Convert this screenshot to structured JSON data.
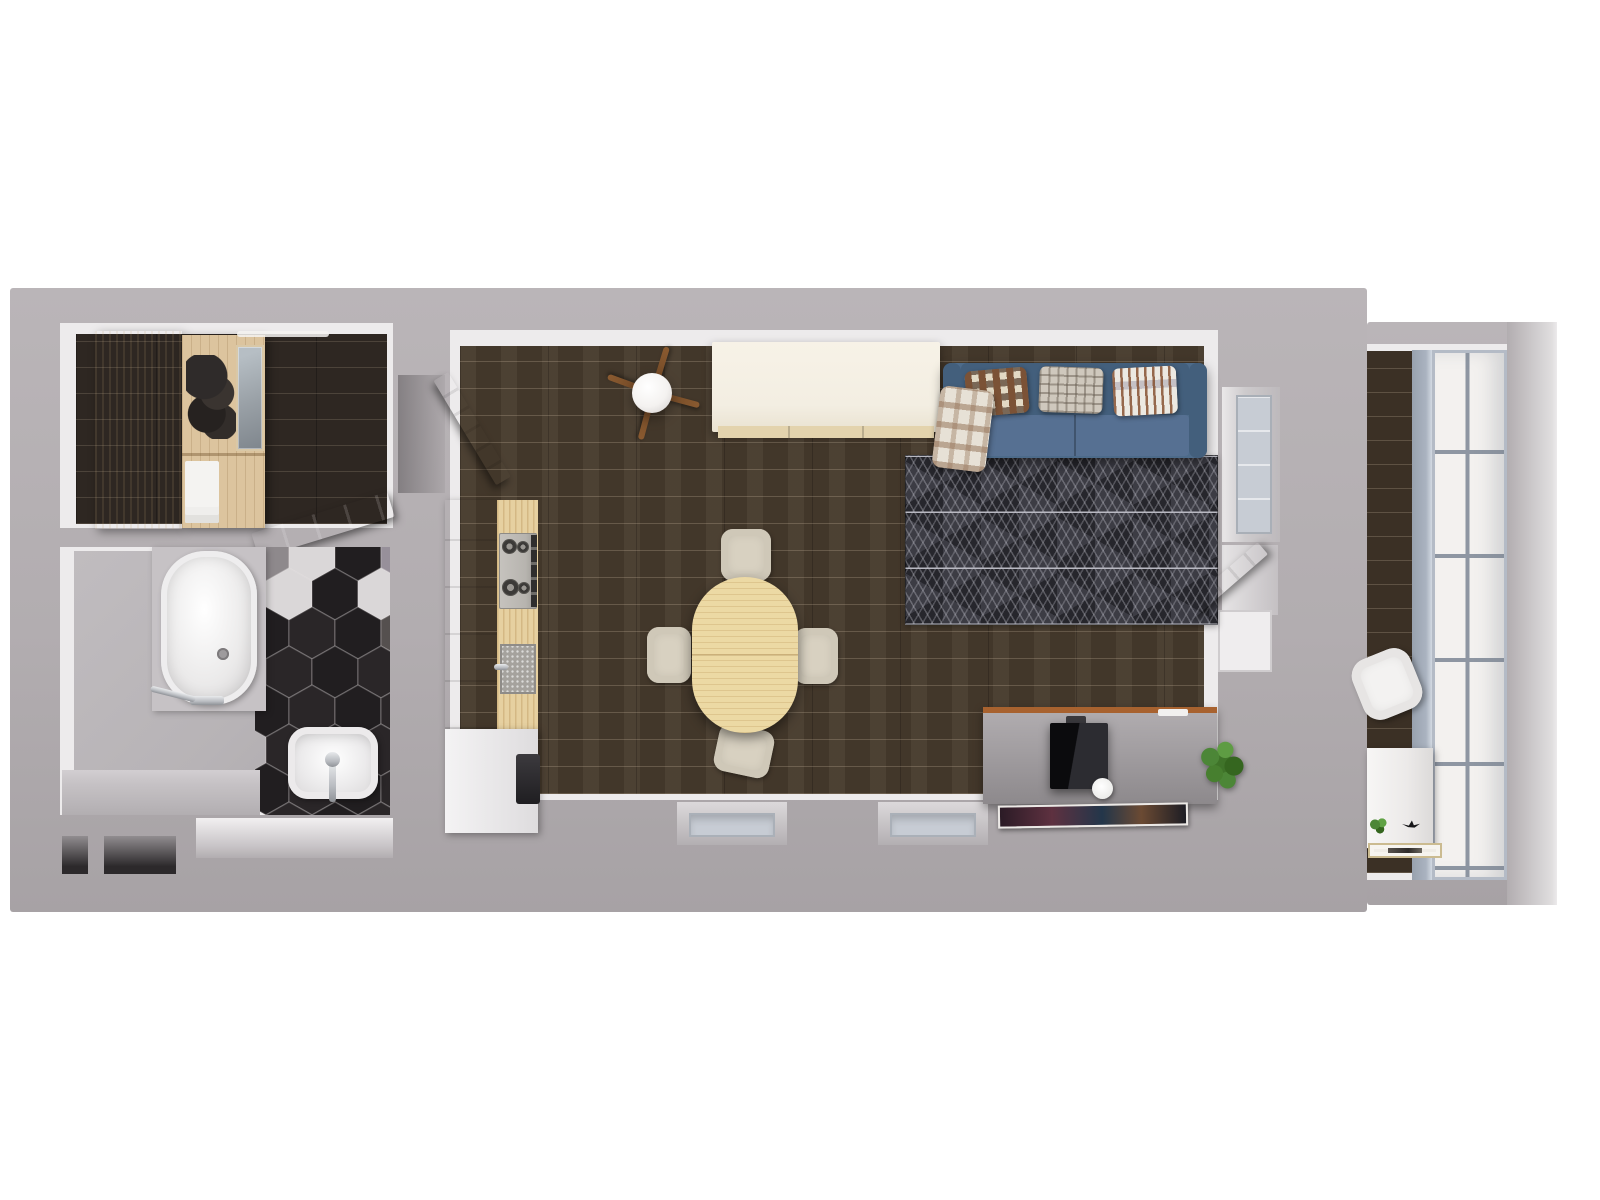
{
  "scene": {
    "type": "3d-floor-plan-top-down-render",
    "rooms": [
      {
        "name": "hallway",
        "furniture": [
          "wardrobe",
          "open-shelves",
          "glass-cabinet",
          "linen-shelves",
          "entry-door",
          "ceiling-light"
        ]
      },
      {
        "name": "bathroom",
        "furniture": [
          "bathtub",
          "bath-faucet",
          "washbasin",
          "hex-tile-floor",
          "ledge"
        ]
      },
      {
        "name": "living-room-kitchen",
        "furniture": [
          "interior-door",
          "kitchen-cabinets",
          "gas-hob",
          "kitchen-sink",
          "base-cabinet",
          "ceiling-lamp",
          "island-cabinet",
          "dining-table",
          "dining-chairs",
          "sofa",
          "cushions",
          "throw-blanket",
          "area-rug",
          "tv-sideboard",
          "tv",
          "paper-roll",
          "potted-plant",
          "poster",
          "window",
          "balcony-door"
        ]
      },
      {
        "name": "balcony",
        "furniture": [
          "glazing",
          "armchair",
          "side-table",
          "plant-sprig",
          "bird-figurine",
          "picture-frame"
        ]
      }
    ]
  },
  "palette": {
    "bg": "#ffffff",
    "wall": "#b2adb0",
    "innerFace": "#edebec",
    "hallFloor": "#2e2722",
    "livingFloor": "#463a2c",
    "balconyFloor": "#3b3025",
    "bathFloor": "#b7b3b6",
    "ledge": "#c6c2c5",
    "nicheDark": "#2c292b",
    "recessLight": "#efedee",
    "glass": "#c7ccd4",
    "glassFrame": "#aab3c0",
    "glazing": "#f3f1ef",
    "mullion": "#8e96a2",
    "birchLight": "#f2e8d6",
    "birch": "#dcc49e",
    "glassDoor": "#99a0a6",
    "towel": "#f4f3f1",
    "doorDark": "#504d51",
    "doorWhite": "#eceaec",
    "cabinetWhite": "#e9e7e9",
    "counterWood": "#e6d0a0",
    "steel": "#b7b4af",
    "burner": "#3c3a38",
    "knobStrip": "#2f2e2d",
    "sinkGranite": "#a5a29d",
    "tableWood": "#ecd9a4",
    "chairCream": "#d8d1c1",
    "island": "#f3eee2",
    "islandShelf": "#e3d3ad",
    "lampWood": "#8a5a30",
    "lampGlobe": "#f4f2f0",
    "sofaBlue": "#4d6b8a",
    "sofaBlueDark": "#435f7c",
    "sofaSeat": "#567092",
    "pillowBrown": "#7b5236",
    "pillowTanBase": "#d9cdb4",
    "plaidBase": "#cfc8bd",
    "stripeBase": "#ece9e2",
    "blanket": "#e7e1d6",
    "rugBase": "#303036",
    "rugTri": "#3c3c44",
    "rugLine": "#b9b9c2",
    "sideboard": "#a29ea1",
    "woodTrim": "#a8622f",
    "tvBlack": "#161618",
    "plantGreen": "#4c8637",
    "plantDark": "#35661f",
    "chrome": "#b9bcc1",
    "tubWhite": "#f4f3f2",
    "hexBlack": "#211e20",
    "hexBlack2": "#2a2628",
    "hexWhite": "#dad7d8",
    "hexGray": "#8e898c",
    "hexPink": "#97909a",
    "hexDark": "#55504f"
  },
  "hex_tiles": {
    "rows": 8,
    "cols": 4,
    "rx": 23,
    "ry": 26,
    "stepX": 46,
    "stepY": 39,
    "accents": {
      "0,0": "hexGray",
      "1,0": "hexWhite",
      "3,0": "hexPink",
      "0,1": "hexWhite",
      "2,1": "hexWhite",
      "3,2": "hexDark"
    }
  }
}
